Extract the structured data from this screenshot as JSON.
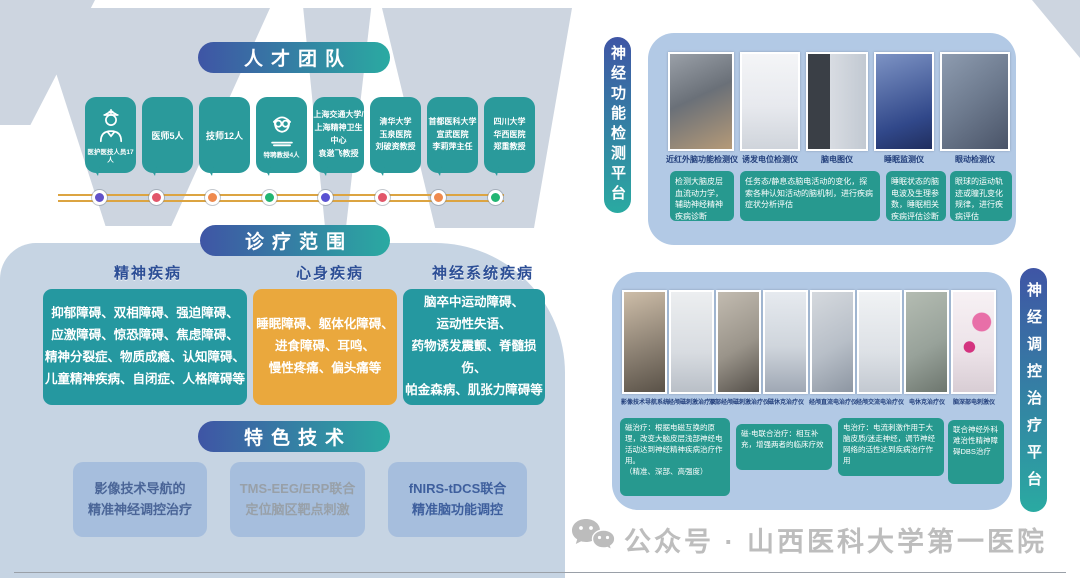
{
  "colors": {
    "teal": "#2a9a9b",
    "scope_teal": "#2598a0",
    "orange": "#eaa83d",
    "navy": "#2d4f96",
    "pill_gradient_start": "#3f55a5",
    "pill_gradient_end": "#2aaaa2",
    "panel_blue": "#b2c9e5",
    "timeline_gold": "#dca441",
    "footer_gray": "#bdbdbd"
  },
  "talent": {
    "title": "人才团队",
    "items": [
      {
        "label": "医护医技人员17人",
        "icon": "doctor-icon",
        "dot_color": "#6252c9"
      },
      {
        "label": "医师5人",
        "dot_color": "#e2566a"
      },
      {
        "label": "技师12人",
        "dot_color": "#ef8a4e"
      },
      {
        "label": "特聘教授4人",
        "icon": "professor-icon",
        "dot_color": "#22b573"
      },
      {
        "label": "上海交通大学/\n上海精神卫生中心\n袁逖飞教授",
        "dot_color": "#5a52d2"
      },
      {
        "label": "清华大学\n玉泉医院\n刘破资教授",
        "dot_color": "#e2566a"
      },
      {
        "label": "首都医科大学\n宣武医院\n李莉萍主任",
        "dot_color": "#ef8a4e"
      },
      {
        "label": "四川大学\n华西医院\n郑重教授",
        "dot_color": "#22b573"
      }
    ]
  },
  "scope": {
    "title": "诊疗范围",
    "categories": [
      {
        "name": "精神疾病",
        "items": "抑郁障碍、双相障碍、强迫障碍、\n应激障碍、惊恐障碍、焦虑障碍、\n精神分裂症、物质成瘾、认知障碍、\n儿童精神疾病、自闭症、人格障碍等"
      },
      {
        "name": "心身疾病",
        "items": "睡眠障碍、躯体化障碍、\n进食障碍、耳鸣、\n慢性疼痛、偏头痛等"
      },
      {
        "name": "神经系统疾病",
        "items": "脑卒中运动障碍、\n运动性失语、\n药物诱发震颤、脊髓损伤、\n帕金森病、肌张力障碍等"
      }
    ]
  },
  "tech": {
    "title": "特色技术",
    "items": [
      "影像技术导航的\n精准神经调控治疗",
      "TMS-EEG/ERP联合\n定位脑区靶点刺激",
      "fNIRS-tDCS联合\n精准脑功能调控"
    ]
  },
  "detection": {
    "title": "神经功能检测平台",
    "equipment": [
      "近红外脑功能检测仪",
      "诱发电位检测仪",
      "脑电图仪",
      "睡眠监测仪",
      "眼动检测仪"
    ],
    "captions": [
      "检测大脑皮层血流动力学，辅助神经精神疾病诊断",
      "任务态/静息态脑电活动的变化，探索各种认知活动的脑机制，进行疾病症状分析评估",
      "睡眠状态的脑电波及生理参数，睡眠相关疾病评估诊断",
      "眼球的运动轨迹或瞳孔变化规律，进行疾病评估"
    ]
  },
  "treatment": {
    "title": "神经调控治疗平台",
    "equipment": [
      "影像技术导航系统",
      "经颅磁刺激治疗仪",
      "深部经颅磁刺激治疗仪",
      "磁休克治疗仪",
      "经颅直流电治疗仪",
      "经颅交流电治疗仪",
      "电休克治疗仪",
      "脑深部电刺激仪"
    ],
    "captions": [
      "磁治疗：根据电磁互换的原理，改变大脑皮层浅部神经电活动达到神经精神疾病治疗作用。\n（精准、深部、高强度）",
      "磁-电联合治疗：相互补充，增强两者的临床疗效",
      "电治疗：电流刺激作用于大脑皮质/迷走神经，调节神经网络的活性达到疾病治疗作用",
      "联合神经外科难治性精神障碍DBS治疗"
    ]
  },
  "footer": {
    "wechat_label": "公众号 · 山西医科大学第一医院"
  }
}
